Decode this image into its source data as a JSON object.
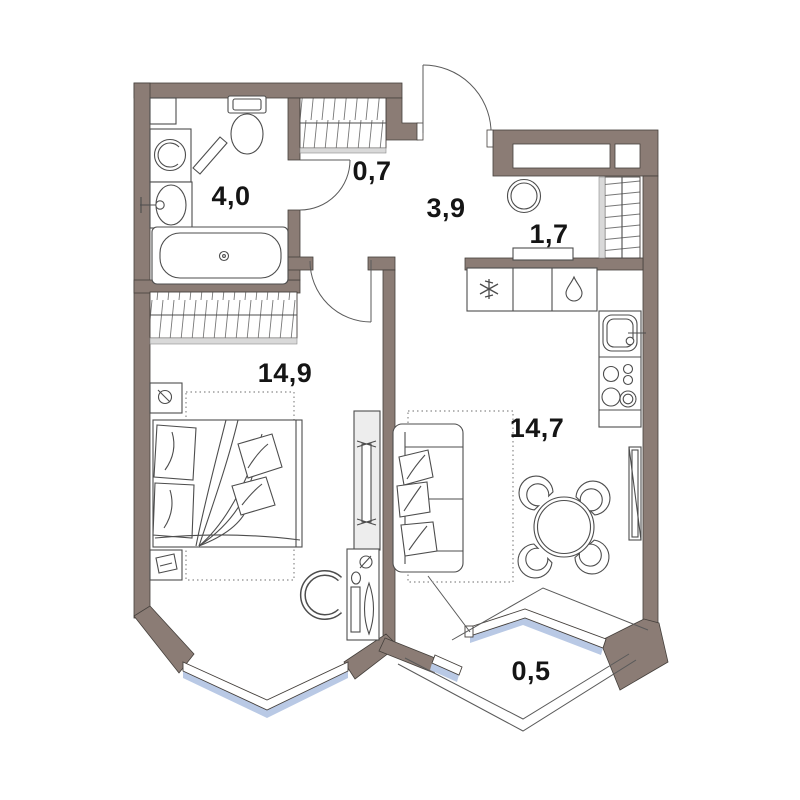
{
  "plan": {
    "title": "One-bedroom apartment floor plan",
    "rooms": {
      "bathroom": {
        "name": "bathroom",
        "area": "4,0"
      },
      "hall_closet": {
        "name": "hall closet",
        "area": "0,7"
      },
      "hallway": {
        "name": "hallway",
        "area": "3,9"
      },
      "pantry": {
        "name": "pantry",
        "area": "1,7"
      },
      "bedroom": {
        "name": "bedroom",
        "area": "14,9"
      },
      "living_kitchen": {
        "name": "living-kitchen",
        "area": "14,7"
      },
      "balcony": {
        "name": "balcony",
        "area": "0,5"
      }
    },
    "colors": {
      "wall": "#8b7c75",
      "glass": "#b9c9e5",
      "line": "#4d4d4d",
      "label": "#151515",
      "background": "#ffffff"
    }
  }
}
